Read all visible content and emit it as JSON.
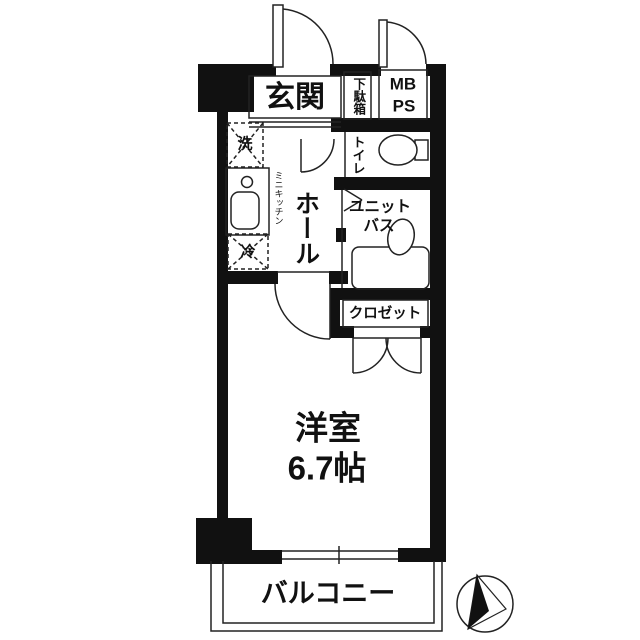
{
  "floorplan": {
    "title": "1K apartment floor plan",
    "rooms": {
      "entrance": {
        "label": "玄関"
      },
      "shoe_box": {
        "label": "下駄箱"
      },
      "meter_box": {
        "line1": "MB",
        "line2": "PS"
      },
      "toilet": {
        "label": "トイレ"
      },
      "hall": {
        "label": "ホール"
      },
      "mini_kitchen": {
        "label": "ミニキッチン"
      },
      "washer": {
        "label": "洗"
      },
      "fridge": {
        "label": "冷"
      },
      "unit_bath": {
        "line1": "ユニット",
        "line2": "バス"
      },
      "closet": {
        "label": "クロゼット"
      },
      "western_room": {
        "name": "洋室",
        "size": "6.7帖"
      },
      "balcony": {
        "label": "バルコニー"
      }
    },
    "icons": {
      "north_arrow": "compass-north-arrow"
    },
    "colors": {
      "wall": "#111111",
      "line": "#222222",
      "background": "#ffffff"
    }
  }
}
